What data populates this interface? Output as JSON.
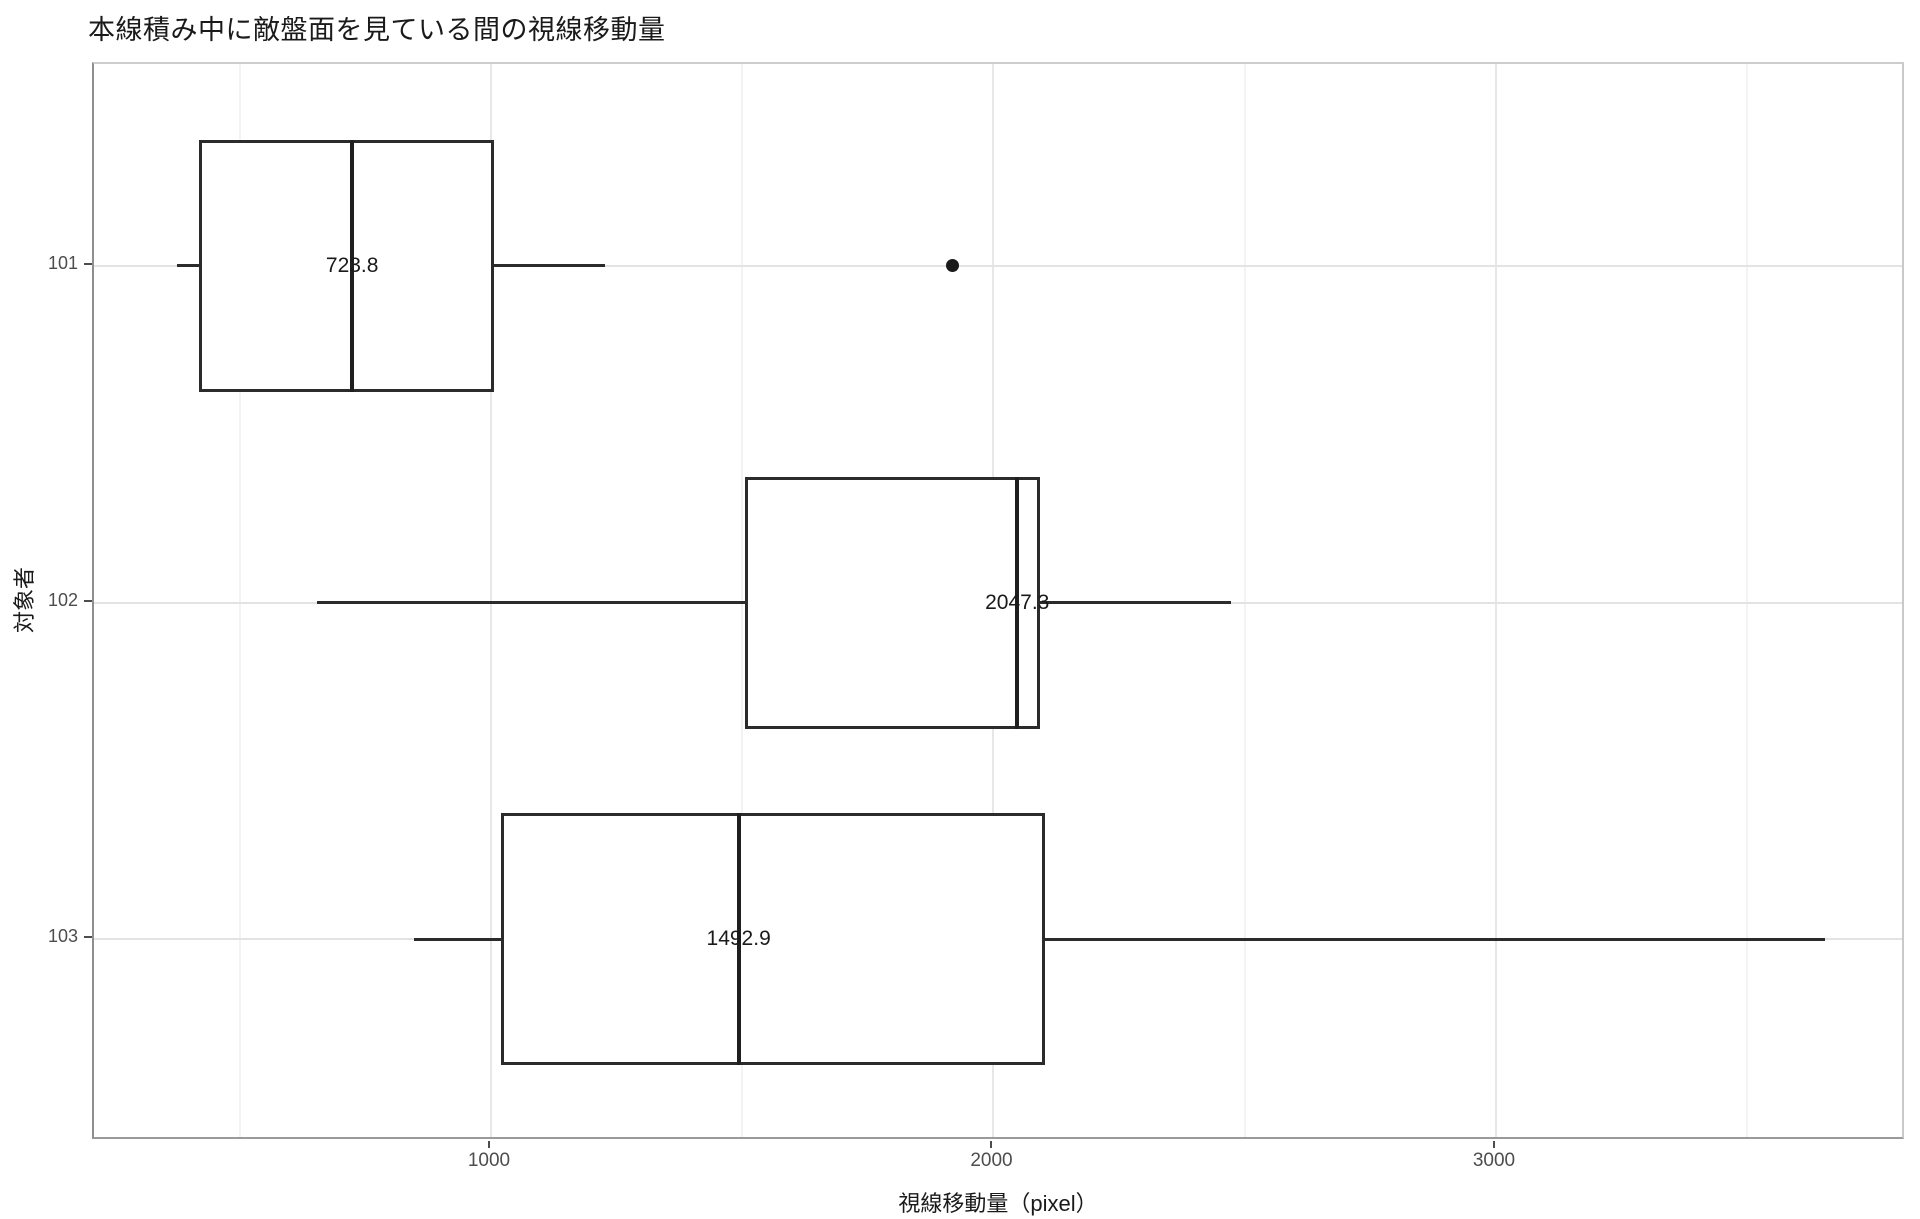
{
  "chart_data": {
    "type": "boxplot",
    "orientation": "horizontal",
    "title": "本線積み中に敵盤面を見ている間の視線移動量",
    "xlabel": "視線移動量（pixel）",
    "ylabel": "対象者",
    "x_axis": {
      "range": [
        210,
        3816
      ],
      "major_ticks": [
        {
          "value": 1000,
          "label": "1000"
        },
        {
          "value": 2000,
          "label": "2000"
        },
        {
          "value": 3000,
          "label": "3000"
        }
      ],
      "minor_ticks": [
        500,
        1500,
        2500,
        3500
      ],
      "grid": true
    },
    "categories": [
      {
        "label": "101"
      },
      {
        "label": "102"
      },
      {
        "label": "103"
      }
    ],
    "boxes": [
      {
        "category": "101",
        "whisker_low": 375,
        "q1": 419,
        "median": 723.8,
        "q3": 1006,
        "whisker_high": 1227,
        "outliers": [
          1918
        ],
        "median_label": "723.8"
      },
      {
        "category": "102",
        "whisker_low": 654,
        "q1": 1505,
        "median": 2047.3,
        "q3": 2092,
        "whisker_high": 2473,
        "outliers": [],
        "median_label": "2047.3"
      },
      {
        "category": "103",
        "whisker_low": 847,
        "q1": 1020,
        "median": 1492.9,
        "q3": 2103,
        "whisker_high": 3654,
        "outliers": [],
        "median_label": "1492.9"
      }
    ],
    "colors": {
      "background": "#ffffff",
      "box_border": "#2b2b2b",
      "median": "#1f1f1f",
      "whisker": "#2b2b2b",
      "outlier": "#1a1a1a",
      "grid_major": "#e7e7e7",
      "grid_minor": "#f3f3f3",
      "grid_category": "#e3e3e3",
      "panel_border": "#c9c9c9",
      "tick_label": "#4d4d4d",
      "text": "#1a1a1a"
    }
  }
}
